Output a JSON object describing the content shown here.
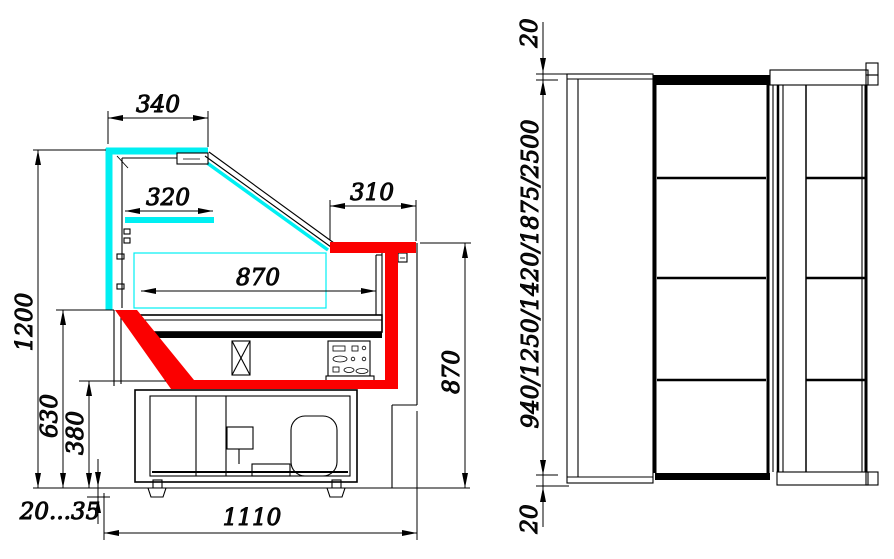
{
  "drawing": {
    "type": "technical-drawing",
    "subject": "refrigerated serve-over display counter: cross-section (left) and plan view (right)",
    "colors": {
      "background": "#ffffff",
      "line_black": "#000000",
      "glass_cyan": "#00eff2",
      "profile_red": "#fb0000"
    },
    "cross_section": {
      "dims": {
        "canopy_depth": "340",
        "shelf_depth": "320",
        "countertop_depth": "310",
        "deck_width": "870",
        "overall_height": "1200",
        "glass_bottom_height": "630",
        "base_top_height": "380",
        "leg_range": "20...35",
        "base_depth": "1110",
        "front_height": "870"
      }
    },
    "plan": {
      "dims": {
        "top_overhang": "20",
        "length_options": "940/1250/1420/1875/2500",
        "bottom_overhang": "20"
      }
    }
  }
}
